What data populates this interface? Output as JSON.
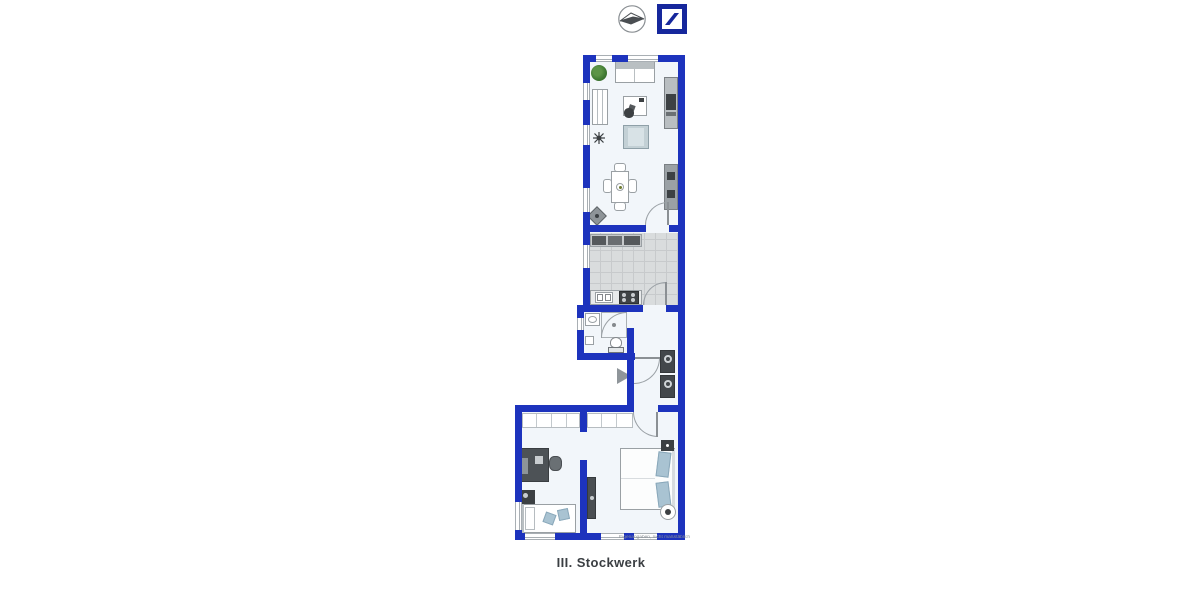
{
  "header": {
    "compass_icon": "north-compass-icon",
    "logo_icon": "deutsche-bank-brand-logo",
    "logo_color": "#16279c"
  },
  "plan": {
    "caption": "III. Stockwerk",
    "disclaimer": "Eigenangaben, nicht maßstäblich",
    "colors": {
      "wall": "#1d33bd",
      "floor": "#f2f6fa",
      "kitchen_tiles": "#d9dcdd",
      "pillow_accent": "#a9c3d2",
      "plant_green": "#3f7a33",
      "furniture_dark": "#42474b"
    },
    "rooms": [
      {
        "name": "living-room",
        "furniture": [
          "plant",
          "sofa",
          "bookshelf",
          "desk",
          "desk-chair",
          "ceiling-fan",
          "armchair",
          "dining-table",
          "dining-chairs",
          "corner-speaker",
          "wardrobe-upper",
          "wardrobe-lower",
          "door"
        ]
      },
      {
        "name": "kitchen",
        "furniture": [
          "upper-counter",
          "lower-counter",
          "sink",
          "stove",
          "door"
        ]
      },
      {
        "name": "bathroom",
        "furniture": [
          "washbasin",
          "shower",
          "toilet",
          "cabinet",
          "door"
        ]
      },
      {
        "name": "hallway",
        "furniture": [
          "entrance-arrow",
          "washer-dryer-stack",
          "entrance-door"
        ]
      },
      {
        "name": "bedroom-left",
        "furniture": [
          "closet-row",
          "desk",
          "desk-chair",
          "nightstand",
          "single-bed",
          "cushions"
        ]
      },
      {
        "name": "bedroom-right",
        "furniture": [
          "closet-row",
          "double-bed",
          "pillows",
          "sideboard",
          "wall-tv",
          "fan",
          "door"
        ]
      }
    ]
  }
}
